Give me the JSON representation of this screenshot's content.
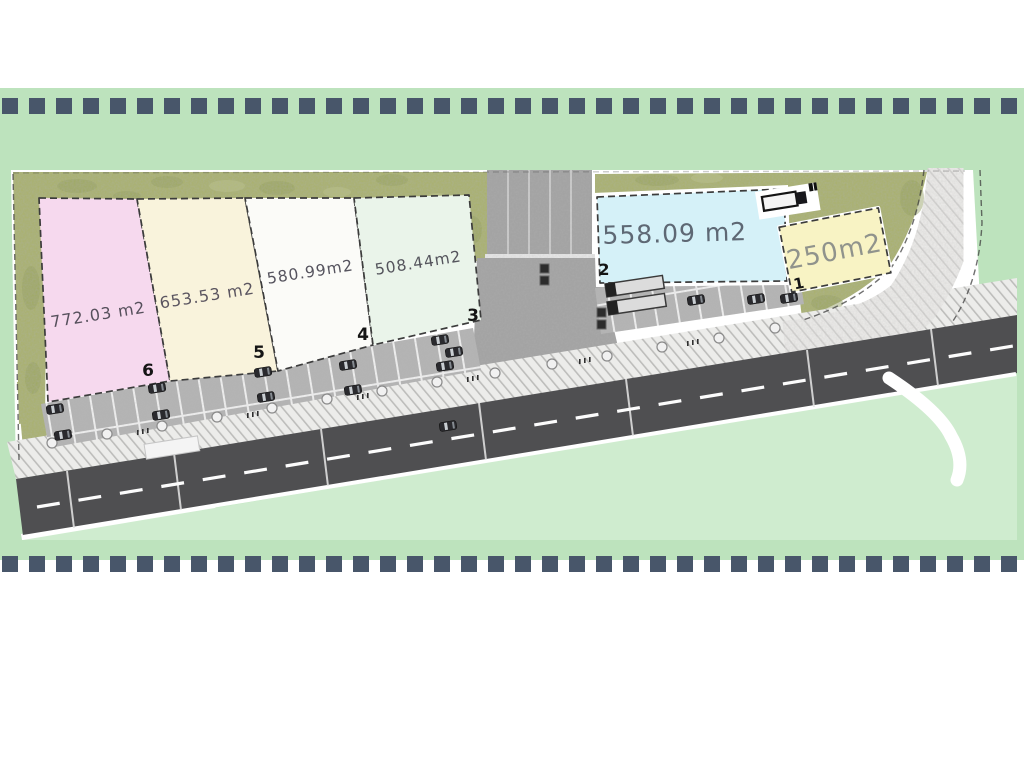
{
  "colors": {
    "page_bg": "#ffffff",
    "band_green": "#bde3bd",
    "dash_slate": "#48566a",
    "road_gray": "#4f4f51",
    "plan_green": "#cfeccf",
    "grass_olive": "#a9b169",
    "pavement_gray": "#a2a2a2"
  },
  "plan": {
    "plots": [
      {
        "number": "6",
        "area": "772.03 m2",
        "fill": "#f6d9ee",
        "label_color": "#56505c"
      },
      {
        "number": "5",
        "area": "653.53 m2",
        "fill": "#f9f3dc",
        "label_color": "#5b5560"
      },
      {
        "number": "4",
        "area": "580.99m2",
        "fill": "#fbfbf8",
        "label_color": "#55535e"
      },
      {
        "number": "3",
        "area": "508.44m2",
        "fill": "#eaf4ea",
        "label_color": "#54545c"
      },
      {
        "number": "2",
        "area": "558.09 m2",
        "fill": "#d5f1f8",
        "label_color": "#5e6874"
      },
      {
        "number": "1",
        "area": "250m2",
        "fill": "#f8f3c4",
        "label_color": "#90938c"
      }
    ],
    "icons": [
      "car-icon",
      "truck-icon",
      "street-tree-icon"
    ]
  }
}
